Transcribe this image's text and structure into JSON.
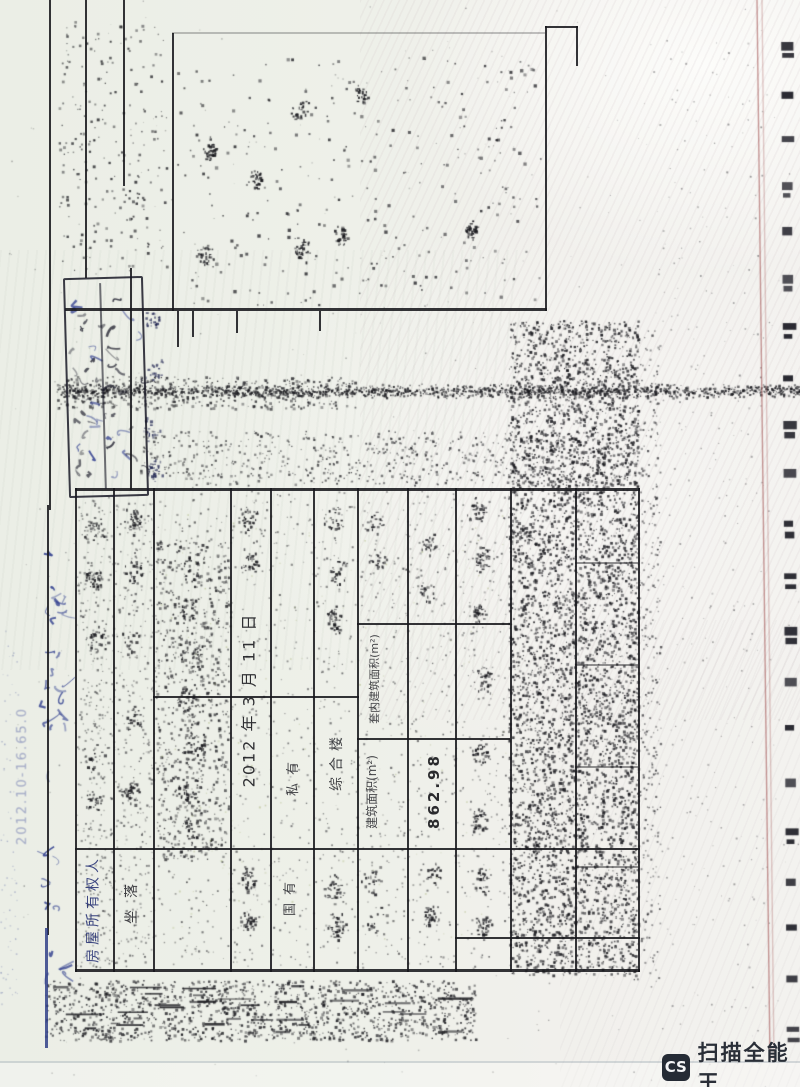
{
  "table": {
    "snippets": [
      {
        "id": "owner-label",
        "text": "房屋所有权人"
      },
      {
        "id": "location-label",
        "text": "坐落"
      },
      {
        "id": "registration-date",
        "text": "2012 年 3 月 11 日"
      },
      {
        "id": "usage-value",
        "text": "综合楼"
      },
      {
        "id": "tenure-value",
        "text": "私有"
      },
      {
        "id": "land-type-value",
        "text": "国有"
      },
      {
        "id": "inner-area-label",
        "text": "套内建筑面积(m²)"
      },
      {
        "id": "area-label",
        "text": "建筑面积(m²)"
      },
      {
        "id": "area-value",
        "text": "862.98"
      }
    ]
  },
  "margin_note": {
    "text": "2012.10-16.65.0"
  },
  "watermark": {
    "badge_label": "CS",
    "app_name": "扫描全能王"
  },
  "colors": {
    "paper": "#eef0e9",
    "ink": "#1a1a1f",
    "blue_ink": "#2c3a8c",
    "red_margin_line": "#9b4646",
    "watermark_dark": "#252b35"
  }
}
